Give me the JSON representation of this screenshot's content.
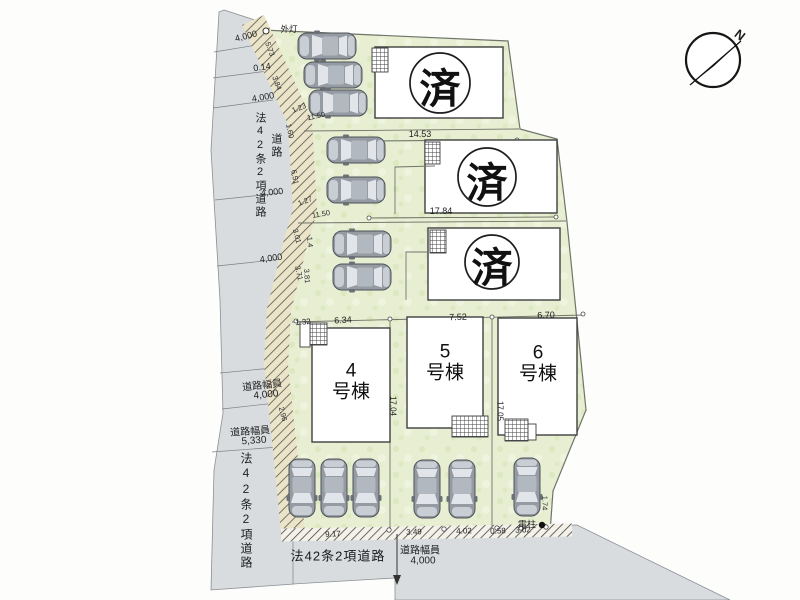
{
  "compass": {
    "north_label": "N"
  },
  "roads": {
    "left_upper": {
      "name": "法42条2項道路",
      "secondary": "道路",
      "dim_top": "4,000",
      "dim_2": "0.14",
      "dim_3": "4,000",
      "dim_4": "4,000",
      "dim_5": "4,000",
      "width_caption_a": "道路幅員",
      "width_value_a": "4,000",
      "width_caption_b": "道路幅員",
      "width_value_b": "5,330"
    },
    "left_lower": {
      "name": "法42条2項道路"
    },
    "bottom": {
      "name": "法42条2項道路",
      "width_caption": "道路幅員",
      "width_value": "4,000",
      "frontage_dims": [
        "9.17",
        "3.49",
        "4.02",
        "0.58",
        "3.02"
      ]
    }
  },
  "site": {
    "sold_mark": "済",
    "units": {
      "u4": {
        "number": "4",
        "suffix": "号棟"
      },
      "u5": {
        "number": "5",
        "suffix": "号棟"
      },
      "u6": {
        "number": "6",
        "suffix": "号棟"
      }
    },
    "features": {
      "streetlight": "外灯",
      "utility_pole": "電柱"
    },
    "dims": {
      "lot2_frontage": "14.53",
      "lot3_frontage": "17.84",
      "row_offset": "1.32",
      "u4_frontage": "6.34",
      "u5_frontage": "7.52",
      "u6_frontage": "6.70",
      "u4_depth": "17.04",
      "u6_depth": "17.05",
      "pole_offset": "1.74",
      "lot3_side": [
        "1.4",
        "3.81"
      ],
      "boundary_segments": [
        "5.73",
        "3.84",
        "1.23",
        "11.50",
        "1.60",
        "6.51",
        "1.27",
        "11.50",
        "3.01",
        "3.71",
        "2.96"
      ]
    }
  }
}
